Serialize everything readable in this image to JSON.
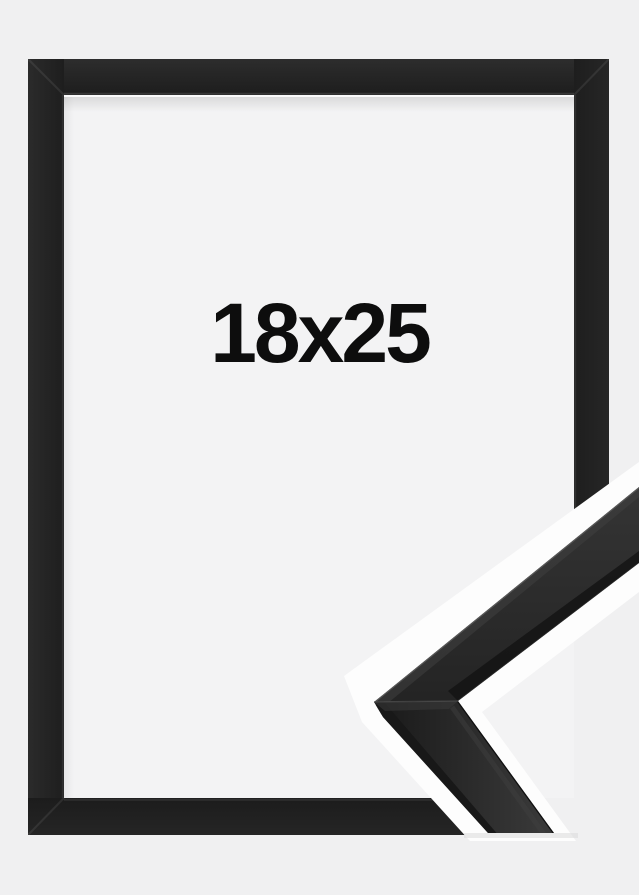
{
  "frame": {
    "size_label": "18x25"
  },
  "colors": {
    "background": "#f0f0f1",
    "opening": "#f3f3f4",
    "frame_black": "#232323",
    "detail_outline": "#fdfdfd",
    "label_text": "#0d0d0d"
  }
}
